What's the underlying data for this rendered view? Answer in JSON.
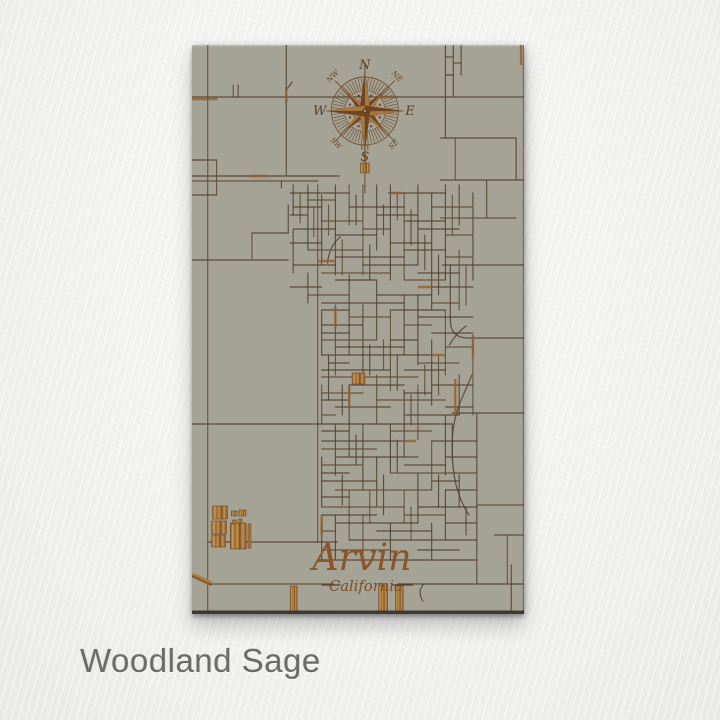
{
  "finish": {
    "label": "Woodland Sage"
  },
  "map": {
    "title": {
      "city": "Arvin",
      "state": "California"
    },
    "compass": {
      "cx": 176,
      "cy": 66,
      "n": "N",
      "e": "E",
      "s": "S",
      "w": "W",
      "nw": "NW",
      "ne": "NE",
      "se": "SE",
      "sw": "SW"
    },
    "palette": {
      "panel": "#a5a296",
      "line": "#52402e",
      "line_soft": "#614b33",
      "rust": "#935f2c",
      "wood_dark": "#6d4520",
      "wood_mid": "#a97a3c",
      "wood_light": "#c99d58",
      "title": "#8a5527",
      "letter": "#5d4020",
      "edge": "#3e3a31",
      "tick": "#6b4726"
    },
    "streets": [
      [
        16,
        0,
        16,
        568
      ],
      [
        96,
        0,
        96,
        131
      ],
      [
        0,
        52,
        338,
        52
      ],
      [
        42,
        40,
        42,
        52
      ],
      [
        47,
        40,
        47,
        52
      ],
      [
        0,
        115,
        25,
        115
      ],
      [
        25,
        115,
        25,
        150
      ],
      [
        0,
        150,
        25,
        150
      ],
      [
        0,
        131,
        150,
        131
      ],
      [
        0,
        136,
        128,
        136
      ],
      [
        91,
        136,
        91,
        143
      ],
      [
        0,
        215,
        98,
        215
      ],
      [
        61,
        188,
        61,
        215
      ],
      [
        61,
        188,
        98,
        188
      ],
      [
        98,
        160,
        98,
        188
      ],
      [
        128,
        140,
        128,
        497
      ],
      [
        0,
        379,
        265,
        379
      ],
      [
        16,
        497,
        148,
        497
      ],
      [
        16,
        539,
        144,
        539
      ],
      [
        210,
        539,
        338,
        539
      ],
      [
        308,
        490,
        338,
        490
      ],
      [
        321,
        490,
        321,
        539
      ],
      [
        258,
        0,
        258,
        93
      ],
      [
        266,
        0,
        266,
        52
      ],
      [
        258,
        12,
        266,
        12
      ],
      [
        258,
        30,
        266,
        30
      ],
      [
        274,
        0,
        274,
        30
      ],
      [
        266,
        18,
        274,
        18
      ],
      [
        253,
        93,
        330,
        93
      ],
      [
        253,
        135,
        338,
        135
      ],
      [
        253,
        173,
        330,
        173
      ],
      [
        255,
        220,
        338,
        220
      ],
      [
        300,
        135,
        300,
        173
      ],
      [
        268,
        93,
        268,
        135
      ],
      [
        330,
        93,
        330,
        135
      ],
      [
        265,
        368,
        338,
        368
      ],
      [
        290,
        460,
        338,
        460
      ],
      [
        290,
        368,
        290,
        539
      ],
      [
        325,
        520,
        325,
        568
      ],
      [
        176,
        20,
        176,
        148
      ],
      [
        103,
        140,
        103,
        170
      ],
      [
        103,
        185,
        103,
        228
      ],
      [
        110,
        148,
        110,
        178
      ],
      [
        118,
        140,
        118,
        205
      ],
      [
        118,
        228,
        118,
        258
      ],
      [
        124,
        162,
        124,
        192
      ],
      [
        132,
        150,
        132,
        220
      ],
      [
        132,
        265,
        132,
        310
      ],
      [
        132,
        340,
        132,
        379
      ],
      [
        132,
        412,
        132,
        462
      ],
      [
        132,
        478,
        132,
        515
      ],
      [
        139,
        160,
        139,
        190
      ],
      [
        139,
        310,
        139,
        355
      ],
      [
        146,
        140,
        146,
        230
      ],
      [
        146,
        260,
        146,
        330
      ],
      [
        146,
        380,
        146,
        430
      ],
      [
        146,
        470,
        146,
        515
      ],
      [
        153,
        195,
        153,
        230
      ],
      [
        153,
        340,
        153,
        370
      ],
      [
        153,
        430,
        153,
        460
      ],
      [
        160,
        140,
        160,
        180
      ],
      [
        160,
        230,
        160,
        310
      ],
      [
        160,
        340,
        160,
        412
      ],
      [
        160,
        445,
        160,
        495
      ],
      [
        167,
        150,
        167,
        180
      ],
      [
        167,
        390,
        167,
        420
      ],
      [
        174,
        140,
        174,
        230
      ],
      [
        174,
        260,
        174,
        340
      ],
      [
        174,
        379,
        174,
        445
      ],
      [
        174,
        470,
        174,
        515
      ],
      [
        181,
        200,
        181,
        235
      ],
      [
        181,
        300,
        181,
        330
      ],
      [
        181,
        445,
        181,
        478
      ],
      [
        188,
        140,
        188,
        205
      ],
      [
        188,
        235,
        188,
        295
      ],
      [
        188,
        330,
        188,
        379
      ],
      [
        188,
        412,
        188,
        462
      ],
      [
        195,
        160,
        195,
        190
      ],
      [
        195,
        295,
        195,
        325
      ],
      [
        195,
        430,
        195,
        470
      ],
      [
        202,
        140,
        202,
        235
      ],
      [
        202,
        265,
        202,
        345
      ],
      [
        202,
        379,
        202,
        428
      ],
      [
        202,
        478,
        202,
        515
      ],
      [
        209,
        148,
        209,
        175
      ],
      [
        209,
        310,
        209,
        345
      ],
      [
        209,
        395,
        209,
        428
      ],
      [
        216,
        148,
        216,
        235
      ],
      [
        216,
        250,
        216,
        310
      ],
      [
        216,
        345,
        216,
        412
      ],
      [
        216,
        445,
        216,
        478
      ],
      [
        223,
        165,
        223,
        200
      ],
      [
        223,
        350,
        223,
        380
      ],
      [
        223,
        462,
        223,
        495
      ],
      [
        230,
        140,
        230,
        220
      ],
      [
        230,
        250,
        230,
        320
      ],
      [
        230,
        340,
        230,
        395
      ],
      [
        230,
        428,
        230,
        478
      ],
      [
        237,
        190,
        237,
        225
      ],
      [
        237,
        320,
        237,
        350
      ],
      [
        244,
        148,
        244,
        265
      ],
      [
        244,
        295,
        244,
        360
      ],
      [
        244,
        396,
        244,
        445
      ],
      [
        244,
        478,
        244,
        515
      ],
      [
        251,
        210,
        251,
        250
      ],
      [
        251,
        310,
        251,
        350
      ],
      [
        251,
        430,
        251,
        462
      ],
      [
        258,
        140,
        258,
        235
      ],
      [
        258,
        265,
        258,
        330
      ],
      [
        258,
        370,
        258,
        430
      ],
      [
        258,
        445,
        258,
        495
      ],
      [
        265,
        150,
        265,
        190
      ],
      [
        265,
        379,
        265,
        415
      ],
      [
        272,
        140,
        272,
        180
      ],
      [
        272,
        205,
        272,
        265
      ],
      [
        272,
        330,
        272,
        370
      ],
      [
        272,
        430,
        272,
        462
      ],
      [
        279,
        220,
        279,
        260
      ],
      [
        279,
        462,
        279,
        490
      ],
      [
        286,
        148,
        286,
        235
      ],
      [
        286,
        290,
        286,
        370
      ],
      [
        100,
        148,
        160,
        148
      ],
      [
        200,
        148,
        258,
        148
      ],
      [
        118,
        155,
        146,
        155
      ],
      [
        103,
        162,
        132,
        162
      ],
      [
        160,
        162,
        216,
        162
      ],
      [
        244,
        162,
        286,
        162
      ],
      [
        100,
        170,
        118,
        170
      ],
      [
        188,
        170,
        230,
        170
      ],
      [
        132,
        176,
        174,
        176
      ],
      [
        216,
        176,
        258,
        176
      ],
      [
        103,
        184,
        146,
        184
      ],
      [
        174,
        184,
        202,
        184
      ],
      [
        230,
        184,
        272,
        184
      ],
      [
        146,
        190,
        188,
        190
      ],
      [
        258,
        190,
        286,
        190
      ],
      [
        100,
        198,
        132,
        198
      ],
      [
        202,
        198,
        244,
        198
      ],
      [
        118,
        205,
        174,
        205
      ],
      [
        216,
        205,
        258,
        205
      ],
      [
        146,
        212,
        216,
        212
      ],
      [
        258,
        212,
        286,
        212
      ],
      [
        103,
        220,
        146,
        220
      ],
      [
        174,
        220,
        230,
        220
      ],
      [
        132,
        228,
        202,
        228
      ],
      [
        230,
        228,
        272,
        228
      ],
      [
        146,
        235,
        188,
        235
      ],
      [
        216,
        235,
        258,
        235
      ],
      [
        100,
        242,
        132,
        242
      ],
      [
        244,
        242,
        286,
        242
      ],
      [
        118,
        250,
        160,
        250
      ],
      [
        188,
        250,
        244,
        250
      ],
      [
        132,
        258,
        216,
        258
      ],
      [
        244,
        258,
        272,
        258
      ],
      [
        132,
        265,
        160,
        265
      ],
      [
        202,
        265,
        258,
        265
      ],
      [
        160,
        272,
        202,
        272
      ],
      [
        230,
        272,
        286,
        272
      ],
      [
        132,
        280,
        174,
        280
      ],
      [
        216,
        280,
        244,
        280
      ],
      [
        132,
        288,
        160,
        288
      ],
      [
        244,
        288,
        286,
        288
      ],
      [
        132,
        295,
        188,
        295
      ],
      [
        202,
        295,
        230,
        295
      ],
      [
        146,
        302,
        216,
        302
      ],
      [
        258,
        302,
        286,
        302
      ],
      [
        132,
        310,
        244,
        310
      ],
      [
        139,
        318,
        160,
        318
      ],
      [
        230,
        318,
        272,
        318
      ],
      [
        132,
        325,
        202,
        325
      ],
      [
        216,
        325,
        258,
        325
      ],
      [
        132,
        332,
        230,
        332
      ],
      [
        160,
        340,
        216,
        340
      ],
      [
        244,
        340,
        286,
        340
      ],
      [
        132,
        348,
        174,
        348
      ],
      [
        216,
        348,
        244,
        348
      ],
      [
        132,
        355,
        160,
        355
      ],
      [
        188,
        355,
        258,
        355
      ],
      [
        146,
        362,
        202,
        362
      ],
      [
        258,
        362,
        286,
        362
      ],
      [
        132,
        370,
        146,
        370
      ],
      [
        216,
        370,
        272,
        370
      ],
      [
        132,
        386,
        160,
        386
      ],
      [
        202,
        386,
        244,
        386
      ],
      [
        132,
        396,
        216,
        396
      ],
      [
        244,
        396,
        290,
        396
      ],
      [
        132,
        404,
        188,
        404
      ],
      [
        146,
        412,
        230,
        412
      ],
      [
        258,
        412,
        290,
        412
      ],
      [
        132,
        420,
        174,
        420
      ],
      [
        216,
        420,
        258,
        420
      ],
      [
        132,
        428,
        160,
        428
      ],
      [
        202,
        428,
        290,
        428
      ],
      [
        132,
        436,
        188,
        436
      ],
      [
        244,
        436,
        272,
        436
      ],
      [
        146,
        445,
        244,
        445
      ],
      [
        258,
        445,
        290,
        445
      ],
      [
        132,
        452,
        160,
        452
      ],
      [
        132,
        462,
        216,
        462
      ],
      [
        230,
        462,
        290,
        462
      ],
      [
        132,
        470,
        188,
        470
      ],
      [
        216,
        470,
        258,
        470
      ],
      [
        146,
        478,
        230,
        478
      ],
      [
        258,
        478,
        290,
        478
      ],
      [
        132,
        486,
        146,
        486
      ],
      [
        188,
        486,
        244,
        486
      ],
      [
        160,
        495,
        290,
        495
      ],
      [
        132,
        505,
        202,
        505
      ],
      [
        230,
        505,
        272,
        505
      ],
      [
        128,
        515,
        290,
        515
      ]
    ],
    "curves": [
      "M285,330 C276,352 266,366 265,396 C264,430 270,452 282,470",
      "M263,220 L263,275 Q263,293 281,293 L338,293",
      "M262,300 Q270,287 279,281",
      "M236,539 q-7,7 -1,17",
      "M96,45 l6,-8",
      "M138,218 Q140,200 151,192"
    ],
    "rust": [
      [
        0,
        54,
        26,
        54
      ],
      [
        96,
        42,
        96,
        58
      ],
      [
        128,
        216,
        146,
        216
      ],
      [
        146,
        262,
        146,
        284
      ],
      [
        202,
        148,
        214,
        148
      ],
      [
        230,
        242,
        244,
        242
      ],
      [
        160,
        342,
        160,
        362
      ],
      [
        216,
        396,
        228,
        396
      ],
      [
        286,
        290,
        286,
        312
      ],
      [
        268,
        334,
        268,
        368
      ],
      [
        132,
        470,
        132,
        490
      ],
      [
        176,
        108,
        176,
        128
      ],
      [
        58,
        131,
        76,
        131
      ],
      [
        335,
        0,
        335,
        20
      ],
      [
        190,
        52,
        205,
        52
      ],
      [
        244,
        310,
        258,
        310
      ]
    ],
    "blocks": [
      [
        21,
        461,
        15,
        13
      ],
      [
        20,
        476,
        15,
        13
      ],
      [
        20,
        490,
        14,
        12
      ],
      [
        39,
        478,
        16,
        26
      ],
      [
        40,
        466,
        6,
        5
      ],
      [
        48,
        465,
        7,
        6
      ],
      [
        41,
        475,
        4,
        4
      ],
      [
        47,
        474,
        4,
        4
      ],
      [
        57,
        479,
        3,
        24
      ],
      [
        163,
        328,
        13,
        11
      ]
    ],
    "bars": [
      [
        100,
        541,
        7,
        25
      ],
      [
        190,
        540,
        9,
        27
      ],
      [
        207,
        541,
        8,
        26
      ]
    ],
    "dash": [
      0,
      530,
      20,
      539
    ]
  }
}
